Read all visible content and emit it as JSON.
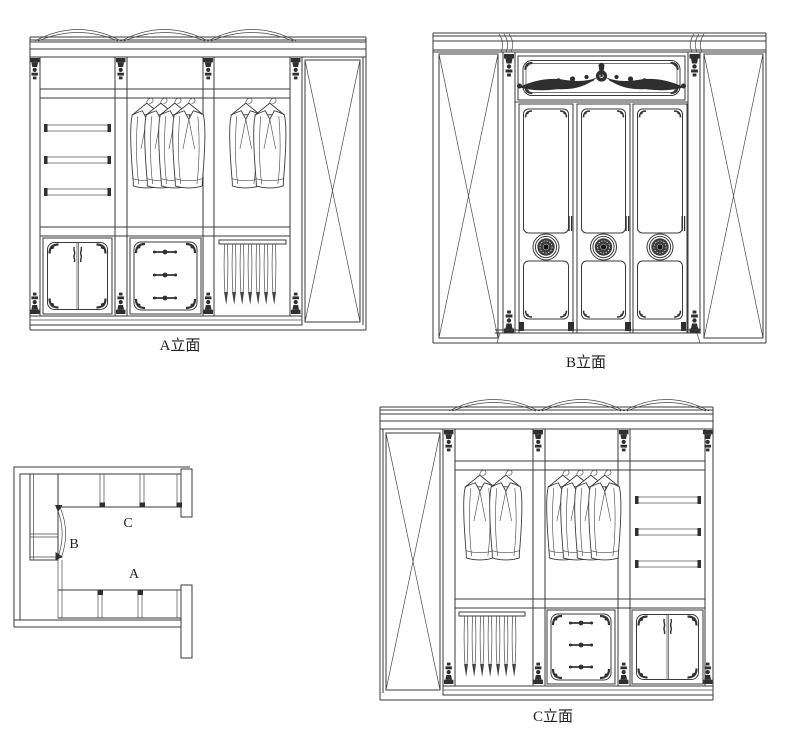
{
  "drawing": {
    "labels": {
      "elevation_a": "A立面",
      "elevation_b": "B立面",
      "elevation_c": "C立面"
    },
    "plan_labels": {
      "a": "A",
      "b": "B",
      "c": "C"
    },
    "colors": {
      "line": "#3a3a3a",
      "ornament": "#2f2f2f",
      "background": "#ffffff"
    },
    "icons": {
      "garment": "hanging-coat",
      "rosette": "carved-door-medallion",
      "crest": "carved-floral-crest",
      "x_panel": "crossed-side-panel"
    }
  }
}
